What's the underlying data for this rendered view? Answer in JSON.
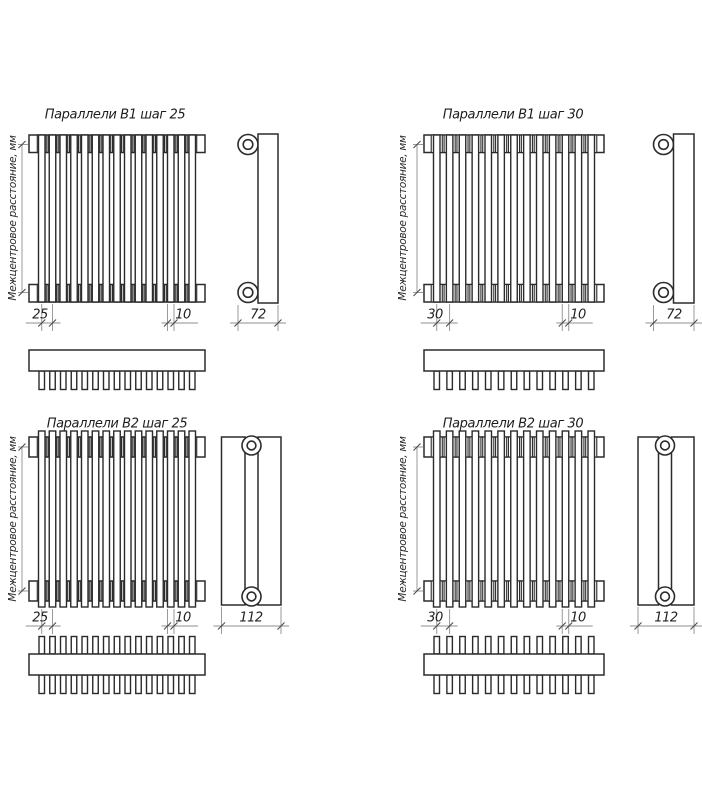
{
  "page": {
    "background": "#ffffff"
  },
  "colors": {
    "line": "#2b2b2b",
    "dimension_line": "#8f8f8f",
    "text": "#1d1d1d"
  },
  "quadrants": [
    {
      "id": "b1-step-25",
      "title": "Параллели В1 шаг 25",
      "axis_label": "Межцентровое расстояние, мм",
      "pitch_label": "25",
      "tube_width_label": "10",
      "depth_label": "72",
      "model": "B1",
      "tube_count": 15
    },
    {
      "id": "b1-step-30",
      "title": "Параллели В1 шаг 30",
      "axis_label": "Межцентровое расстояние, мм",
      "pitch_label": "30",
      "tube_width_label": "10",
      "depth_label": "72",
      "model": "B1",
      "tube_count": 13
    },
    {
      "id": "b2-step-25",
      "title": "Параллели В2 шаг 25",
      "axis_label": "Межцентровое расстояние, мм",
      "pitch_label": "25",
      "tube_width_label": "10",
      "depth_label": "112",
      "model": "B2",
      "tube_count": 15
    },
    {
      "id": "b2-step-30",
      "title": "Параллели В2 шаг 30",
      "axis_label": "Межцентровое расстояние, мм",
      "pitch_label": "30",
      "tube_width_label": "10",
      "depth_label": "112",
      "model": "B2",
      "tube_count": 13
    }
  ]
}
